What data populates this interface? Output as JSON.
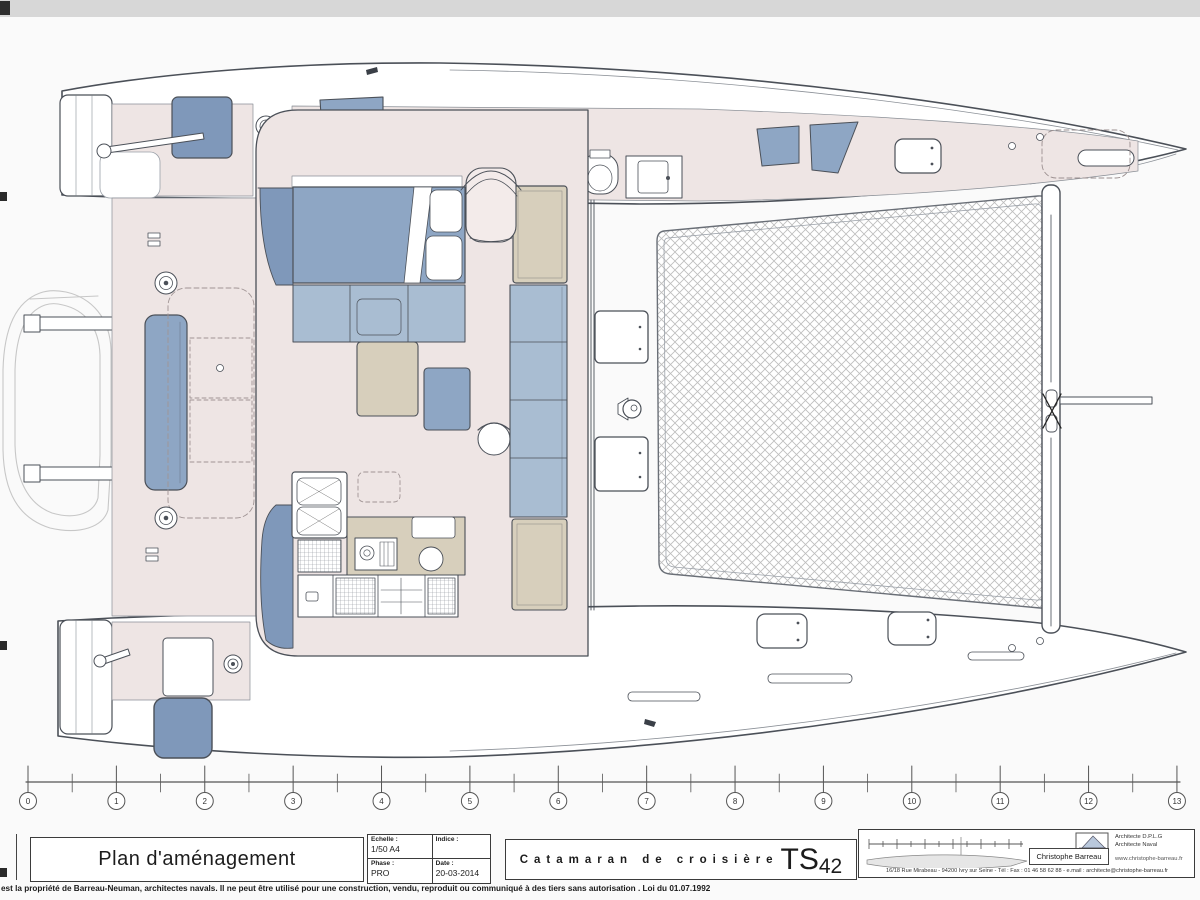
{
  "page": {
    "bg": "#fafafa"
  },
  "colors": {
    "page": "#fafafa",
    "ink": "#4b5058",
    "pink": "#eee5e4",
    "blue": "#8ea6c4",
    "blue2": "#7f98ba",
    "blue3": "#a9bdd2",
    "beige": "#d7cfbc",
    "trampline": "#bdbdbd",
    "ghost": "#c7c7c7"
  },
  "ruler": {
    "marks": [
      "0",
      "1",
      "2",
      "3",
      "4",
      "5",
      "6",
      "7",
      "8",
      "9",
      "10",
      "11",
      "12",
      "13"
    ]
  },
  "title_block": {
    "drawing_title": "Plan d'aménagement",
    "fields": {
      "echelle_label": "Echelle :",
      "echelle_value": "1/50 A4",
      "indice_label": "Indice :",
      "indice_value": "",
      "phase_label": "Phase :",
      "phase_value": "PRO",
      "date_label": "Date :",
      "date_value": "20-03-2014"
    },
    "boat_title": "Catamaran de croisière",
    "boat_model_prefix": "TS",
    "boat_model_number": "42",
    "architect": {
      "name": "Christophe Barreau",
      "title_line1": "Architecte D.P.L.G",
      "title_line2": "Architecte Naval",
      "website": "www.christophe-barreau.fr",
      "address": "16/18 Rue Mirabeau  -  94200 Ivry sur Seine  -  Tél : Fax : 01 46 58 62 88  -  e.mail : architecte@christophe-barreau.fr"
    }
  },
  "copyright": "est la propriété de Barreau-Neuman, architectes navals. Il ne peut être utilisé pour une construction, vendu, reproduit ou communiqué à des tiers sans autorisation . Loi du 01.07.1992"
}
